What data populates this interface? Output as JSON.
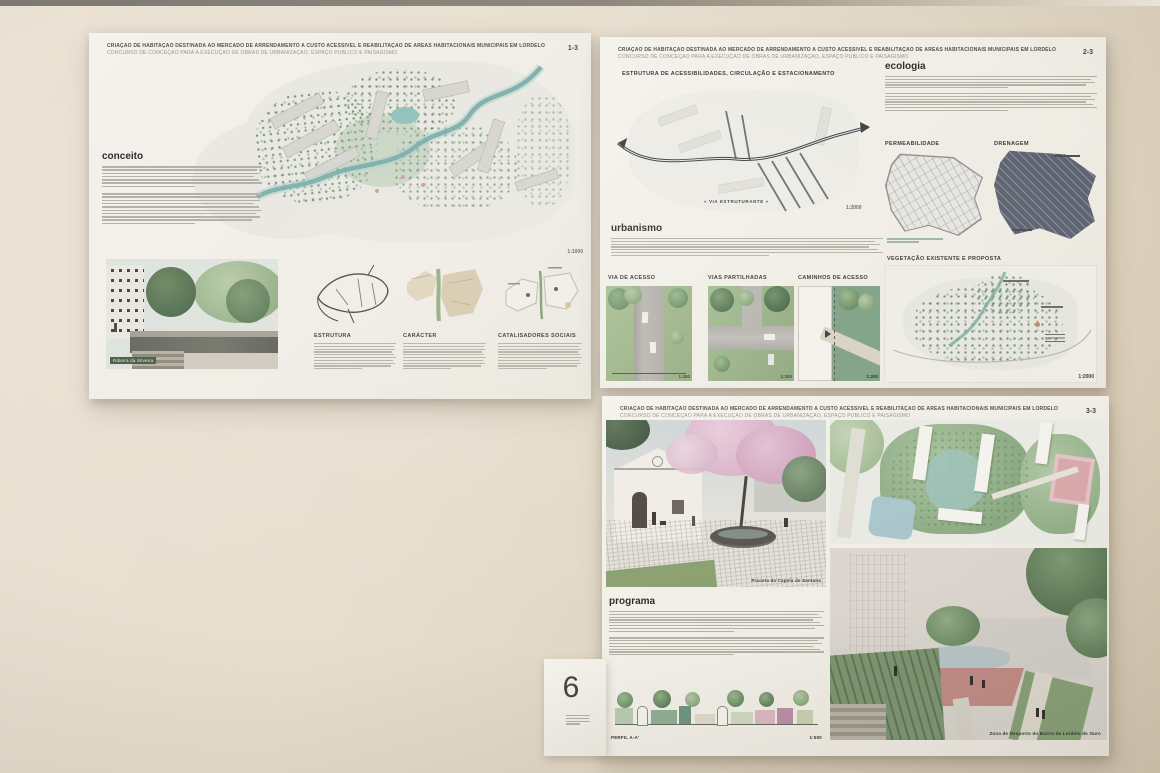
{
  "scene": {
    "wall_color": "#e5dccc",
    "board_color": "#f2f0ea"
  },
  "shared_header": {
    "title": "CRIAÇÃO DE HABITAÇÃO DESTINADA AO MERCADO DE ARRENDAMENTO A CUSTO ACESSÍVEL E REABILITAÇÃO DE ÁREAS HABITACIONAIS MUNICIPAIS EM LORDELO",
    "subtitle": "CONCURSO DE CONCEÇÃO PARA A EXECUÇÃO DE OBRAS DE URBANIZAÇÃO, ESPAÇO PÚBLICO E PAISAGISMO"
  },
  "panel1": {
    "page_number": "1-3",
    "concept_heading": "conceito",
    "plan_scale": "1:1000",
    "render_caption": "Ribeira da Silveira",
    "col1_heading": "ESTRUTURA",
    "col2_heading": "CARÁCTER",
    "col3_heading": "CATALISADORES SOCIAIS"
  },
  "panel2": {
    "page_number": "2-3",
    "access_heading": "ESTRUTURA DE ACESSIBILIDADES, CIRCULAÇÃO E ESTACIONAMENTO",
    "road_label": "« VIA ESTRUTURANTE »",
    "access_scale": "1:2000",
    "urbanism_heading": "urbanismo",
    "ecology_heading": "ecologia",
    "permeability_heading": "PERMEABILIDADE",
    "drainage_heading": "DRENAGEM",
    "vegetation_heading": "VEGETAÇÃO EXISTENTE E PROPOSTA",
    "vegetation_scale": "1:2000",
    "street1_heading": "VIA DE ACESSO",
    "street2_heading": "VIAS PARTILHADAS",
    "street3_heading": "CAMINHOS DE ACESSO",
    "street_scale": "1:200"
  },
  "panel3": {
    "page_number": "3-3",
    "program_heading": "programa",
    "chapel_caption": "Praceta da Capela de Santana",
    "sport_caption": "Zona de Desporto do Bairro de Lordelo do Ouro",
    "profile_label": "PERFIL A-A'",
    "profile_scale": "1:500"
  },
  "exhibit_card": {
    "number": "6"
  }
}
